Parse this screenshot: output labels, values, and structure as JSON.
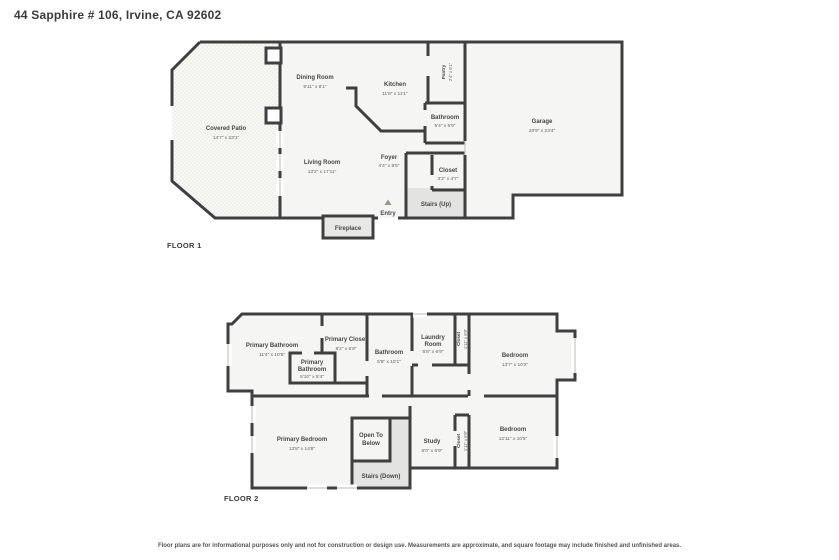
{
  "page": {
    "title": "44 Sapphire # 106, Irvine, CA 92602",
    "disclaimer": "Floor plans are for informational purposes only and not for construction or design use. Measurements are approximate, and square footage may include finished and unfinished areas."
  },
  "colors": {
    "wall": "#3f3f3f",
    "room_fill": "#f5f5f4",
    "stairs_fill": "#e3e3e1",
    "label_text": "#474747"
  },
  "floor1": {
    "label": "FLOOR 1",
    "rooms": {
      "covered_patio": {
        "name": "Covered Patio",
        "dims": "14'7\" x 23'1\""
      },
      "dining_room": {
        "name": "Dining Room",
        "dims": "9'11\" x 8'1\""
      },
      "kitchen": {
        "name": "Kitchen",
        "dims": "11'8\" x 11'1\""
      },
      "pantry": {
        "name": "Pantry",
        "dims": "2'4\" x 5'1\""
      },
      "garage": {
        "name": "Garage",
        "dims": "20'9\" x 23'4\""
      },
      "bathroom": {
        "name": "Bathroom",
        "dims": "5'4\" x 5'9\""
      },
      "living_room": {
        "name": "Living Room",
        "dims": "13'2\" x 17'11\""
      },
      "foyer": {
        "name": "Foyer",
        "dims": "4'4\" x 8'5\""
      },
      "closet": {
        "name": "Closet",
        "dims": "3'2\" x 4'7\""
      },
      "stairs": {
        "name": "Stairs (Up)"
      },
      "entry": {
        "name": "Entry"
      },
      "fireplace": {
        "name": "Fireplace"
      }
    }
  },
  "floor2": {
    "label": "FLOOR 2",
    "rooms": {
      "primary_bathroom": {
        "name": "Primary Bathroom",
        "dims": "11'4\" x 10'5\""
      },
      "primary_closet": {
        "name": "Primary Closet",
        "dims": "8'2\" x 6'9\""
      },
      "primary_bathroom_small": {
        "line1": "Primary",
        "line2": "Bathroom",
        "dims": "5'10\" x 5'4\""
      },
      "bathroom": {
        "name": "Bathroom",
        "dims": "5'8\" x 10'1\""
      },
      "laundry_room": {
        "line1": "Laundry",
        "line2": "Room",
        "dims": "5'8\" x 6'9\""
      },
      "closet_top": {
        "name": "Closet",
        "dims": "1'11\" x 6'9\""
      },
      "bedroom_top": {
        "name": "Bedroom",
        "dims": "13'7\" x 10'2\""
      },
      "primary_bedroom": {
        "name": "Primary Bedroom",
        "dims": "13'8\" x 14'8\""
      },
      "open_to_below": {
        "line1": "Open To",
        "line2": "Below"
      },
      "stairs": {
        "name": "Stairs (Down)"
      },
      "study": {
        "name": "Study",
        "dims": "6'0\" x 6'9\""
      },
      "closet_bottom": {
        "name": "Closet",
        "dims": "1'11\" x 6'9\""
      },
      "bedroom_bottom": {
        "name": "Bedroom",
        "dims": "12'11\" x 10'5\""
      }
    }
  }
}
